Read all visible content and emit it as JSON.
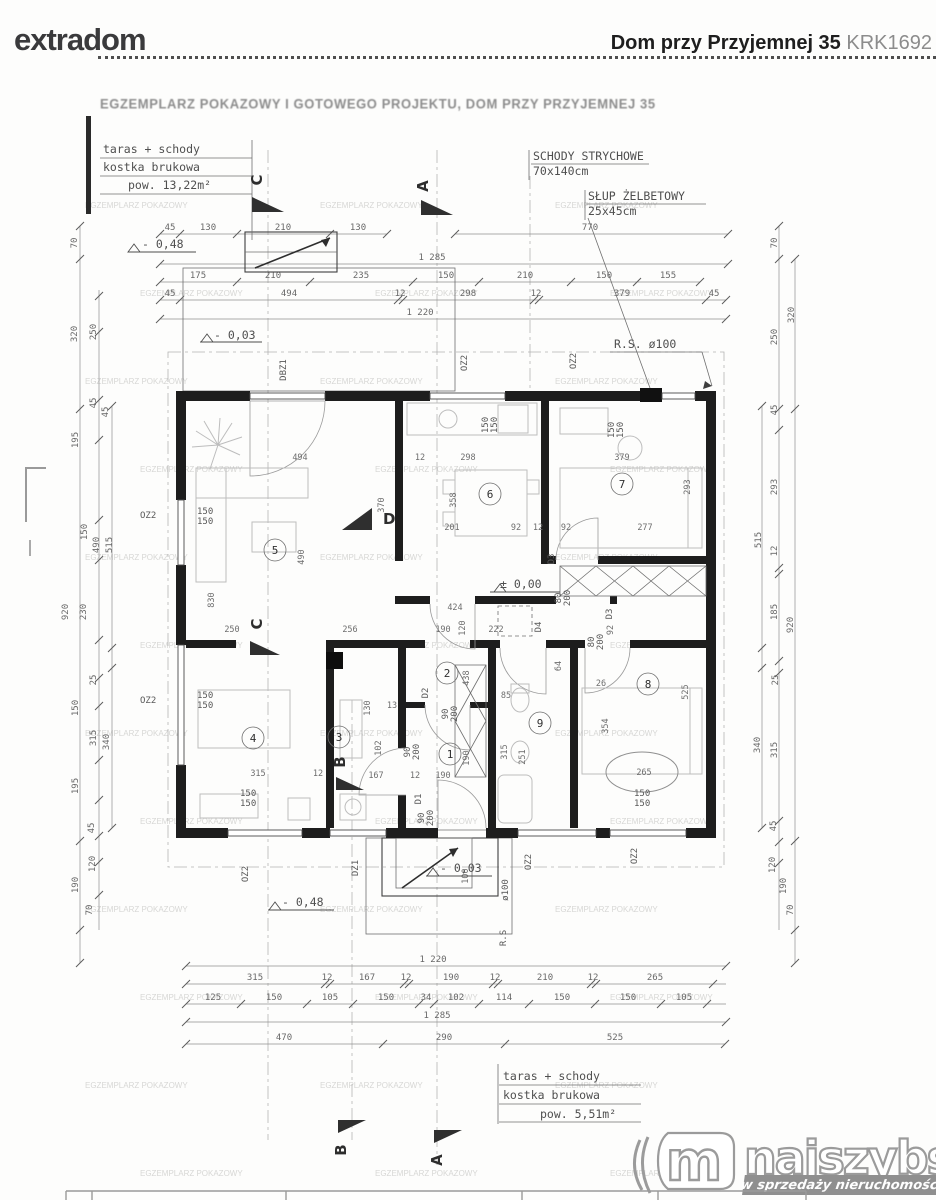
{
  "header": {
    "brand": "extradom",
    "title": "Dom przy Przyjemnej 35",
    "code": "KRK1692"
  },
  "stamp": "EGZEMPLARZ POKAZOWY I GOTOWEGO PROJEKTU, DOM PRZY PRZYJEMNEJ 35",
  "watermark": "EGZEMPLARZ POKAZOWY",
  "notes": {
    "terrace_top": {
      "l1": "taras + schody",
      "l2": "kostka brukowa",
      "l3": "pow. 13,22m²"
    },
    "terrace_bottom": {
      "l1": "taras + schody",
      "l2": "kostka brukowa",
      "l3": "pow. 5,51m²"
    },
    "attic": {
      "l1": "SCHODY STRYCHOWE",
      "l2": "70x140cm"
    },
    "column": {
      "l1": "SŁUP ŻELBETOWY",
      "l2": "25x45cm"
    },
    "rs": "R.S. ø100",
    "pipe": "ø100",
    "rs2": "R.S"
  },
  "levels": {
    "zero": "± 0,00",
    "m003": "- 0,03",
    "m048": "- 0,48"
  },
  "rooms": [
    "1",
    "2",
    "3",
    "4",
    "5",
    "6",
    "7",
    "8",
    "9"
  ],
  "sections": {
    "A": "A",
    "B": "B",
    "C": "C",
    "D": "D"
  },
  "openings": {
    "dbz1": "DBZ1",
    "oz1": "OZ1",
    "oz2": "OZ2",
    "dz1": "DZ1",
    "d1": "D1",
    "d2": "D2",
    "d3": "D3",
    "d4": "D4",
    "s90": "90",
    "s80": "80",
    "s200": "200",
    "s150": "150"
  },
  "dims": {
    "t1": [
      "45",
      "130",
      "210",
      "130"
    ],
    "t1b": "770",
    "t2": "1 285",
    "t3": [
      "175",
      "210",
      "235",
      "150",
      "210",
      "150",
      "155"
    ],
    "t4": [
      "45",
      "494",
      "12",
      "298",
      "12",
      "379",
      "45"
    ],
    "t5": "1 220",
    "b0": "1 220",
    "b1": [
      "315",
      "12",
      "167",
      "12",
      "190",
      "12",
      "210",
      "12",
      "265"
    ],
    "b2": [
      "125",
      "150",
      "105",
      "150",
      "34",
      "102",
      "114",
      "150",
      "150",
      "105"
    ],
    "b3": "1 285",
    "b4": [
      "470",
      "290",
      "525"
    ],
    "left": [
      "70",
      "320",
      "250",
      "45",
      "45",
      "195",
      "150",
      "490",
      "515",
      "920",
      "230",
      "25",
      "150",
      "315",
      "340",
      "195",
      "45",
      "120",
      "190",
      "70"
    ],
    "right": [
      "70",
      "320",
      "250",
      "45",
      "293",
      "515",
      "12",
      "185",
      "920",
      "25",
      "340",
      "315",
      "45",
      "120",
      "190",
      "70"
    ],
    "inner": [
      "494",
      "370",
      "490",
      "830",
      "250",
      "256",
      "12",
      "298",
      "358",
      "201",
      "92",
      "12",
      "379",
      "293",
      "277",
      "92",
      "424",
      "190",
      "120",
      "222",
      "438",
      "85",
      "26",
      "354",
      "525",
      "265",
      "315",
      "12",
      "167",
      "190",
      "102",
      "130",
      "13",
      "12",
      "315",
      "251",
      "64",
      "92",
      "190",
      "100"
    ]
  },
  "logo": {
    "name": "najszybsi",
    "tagline": "w sprzedaży nieruchomości",
    "m": "m"
  }
}
